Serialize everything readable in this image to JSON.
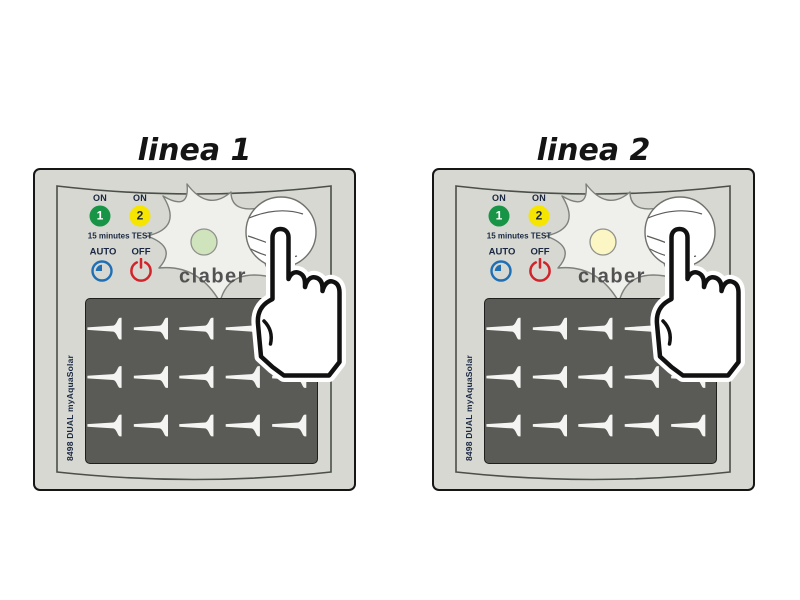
{
  "panels": [
    {
      "title": "linea 1",
      "led_color": "#cfe3bd"
    },
    {
      "title": "linea 2",
      "led_color": "#fbf6c4"
    }
  ],
  "device": {
    "brand": "claber",
    "model": "8498 DUAL myAquaSolar",
    "controls": {
      "on_label": "ON",
      "channel1_number": "1",
      "channel2_number": "2",
      "test_label": "15 minutes TEST",
      "auto_label": "AUTO",
      "off_label": "OFF"
    },
    "colors": {
      "body": "#d6d8d1",
      "channel1": "#189447",
      "channel1_text": "#ffffff",
      "channel2": "#f6e500",
      "channel2_text": "#1a2742",
      "label_text": "#1a2742",
      "auto_icon": "#1f6fb5",
      "off_icon": "#d2232a",
      "brand_text": "#525252"
    }
  }
}
